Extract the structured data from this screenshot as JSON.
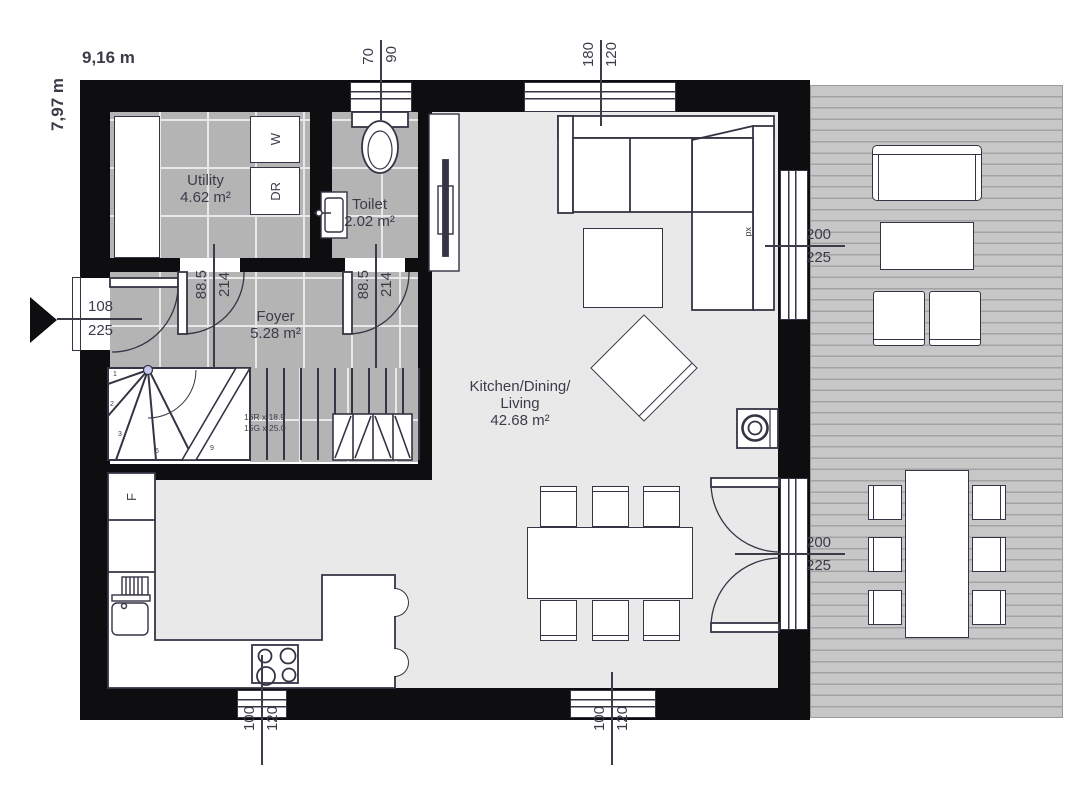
{
  "plan": {
    "width_label": "9,16 m",
    "height_label": "7,97 m"
  },
  "rooms": {
    "utility": {
      "name": "Utility",
      "area": "4.62 m²"
    },
    "toilet": {
      "name": "Toilet",
      "area": "2.02 m²"
    },
    "foyer": {
      "name": "Foyer",
      "area": "5.28 m²"
    },
    "living": {
      "line1": "Kitchen/Dining/",
      "line2": "Living",
      "area": "42.68 m²"
    }
  },
  "appliances": {
    "washer": "W",
    "dryer": "DR",
    "fridge": "F"
  },
  "stairs": {
    "note_line1": "16R x 18.9",
    "note_line2": "15G x 25.0",
    "steps": [
      "1",
      "2",
      "3",
      "5",
      "9"
    ]
  },
  "dimensions": {
    "toilet_window": {
      "w": "70",
      "h": "90"
    },
    "living_window": {
      "w": "180",
      "h": "120"
    },
    "terrace_window": {
      "w": "200",
      "h": "225"
    },
    "terrace_door": {
      "w": "200",
      "h": "225"
    },
    "entry_door": {
      "w": "108",
      "h": "225"
    },
    "utility_door": {
      "w": "88.5",
      "h": "214"
    },
    "toilet_door": {
      "w": "88.5",
      "h": "214"
    },
    "kitchen_window": {
      "w": "100",
      "h": "120"
    },
    "dining_window": {
      "w": "100",
      "h": "120"
    },
    "glazing_note": "px"
  },
  "colors": {
    "wall": "#0e0e11",
    "line": "#343444",
    "tile": "#b4b4b4",
    "grout": "#e8e8e8",
    "floor": "#e9e9ea",
    "terrace": "#c7c7c7",
    "plank": "#a3a3a3",
    "text": "#3c3c49",
    "dot": "#c8c8ea"
  }
}
